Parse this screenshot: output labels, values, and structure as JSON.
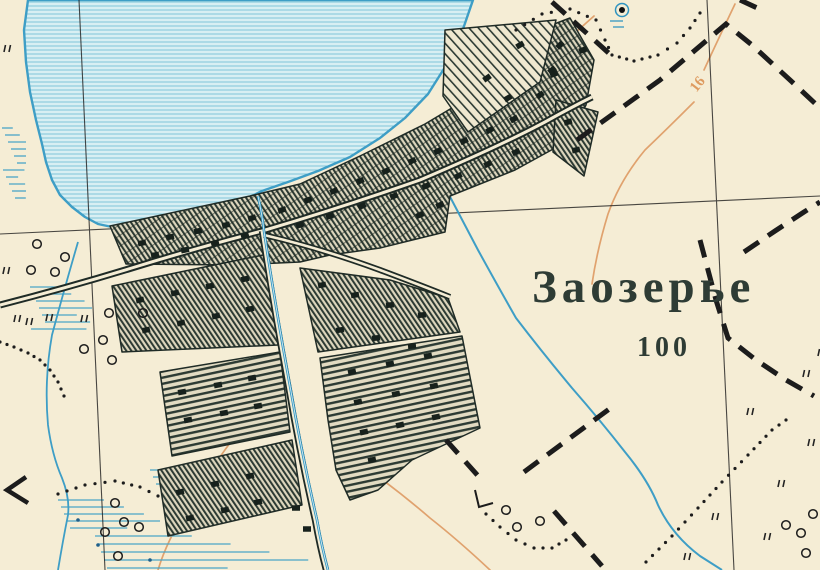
{
  "map": {
    "type": "historical-topographic-map",
    "labels": {
      "settlement_name": "Заозерье",
      "settlement_households": "100",
      "contour_label": "16"
    },
    "colors": {
      "paper": "#f5edd5",
      "water_fill": "#d8eff3",
      "water_line": "#3e9ec6",
      "map_ink": "#1f2b26",
      "contour_orange": "#e0a26e"
    },
    "symbols": {
      "lake": "lake-water-area",
      "village_blocks": "built-up-hatched-blocks",
      "roads": "double-line-roads",
      "streams": "blue-stream-lines",
      "marsh": "blue-marsh-dashes",
      "boundary": "bold-dashed-boundary",
      "trail": "dotted-path",
      "bushes": "small-circle-symbols",
      "meadow": "double-tick-marks",
      "spring": "spring-symbol"
    }
  }
}
